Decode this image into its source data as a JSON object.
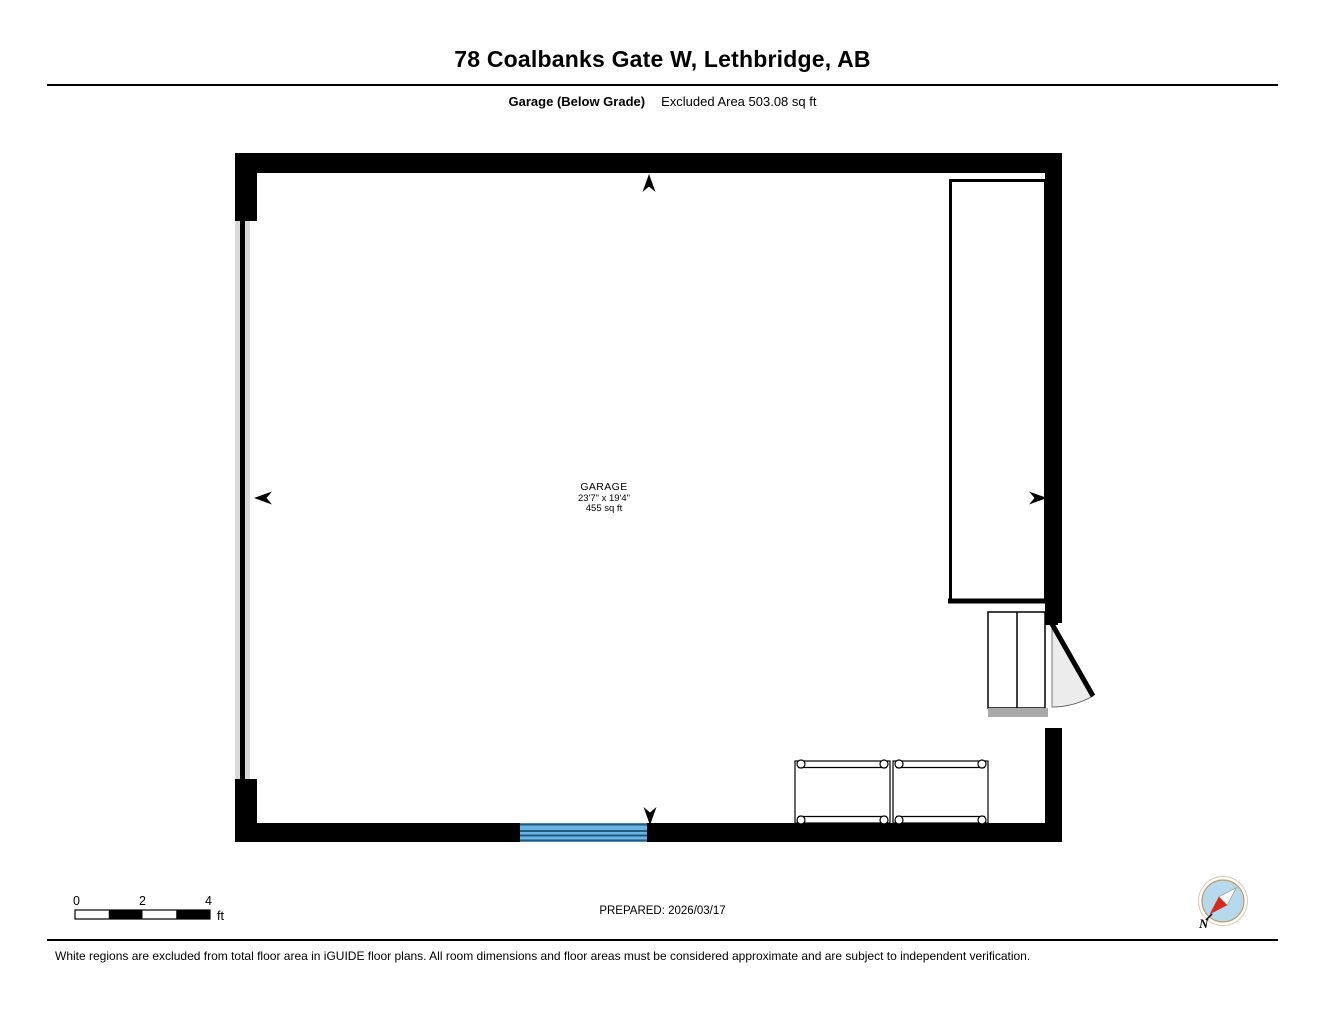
{
  "header": {
    "title": "78 Coalbanks Gate W, Lethbridge, AB",
    "floor_label": "Garage (Below Grade)",
    "excluded_area": "Excluded Area 503.08 sq ft"
  },
  "room": {
    "name": "GARAGE",
    "dimensions": "23'7\" x 19'4\"",
    "area": "455 sq ft"
  },
  "scale_bar": {
    "ticks": [
      "0",
      "2",
      "4"
    ],
    "unit": "ft"
  },
  "compass": {
    "north_label": "N"
  },
  "prepared": {
    "label": "PREPARED: 2026/03/17"
  },
  "disclaimer": "White regions are excluded from total floor area in iGUIDE floor plans. All room dimensions and floor areas must be considered approximate and are subject to independent verification.",
  "colors": {
    "wall": "#000000",
    "window_fill": "#6fb4e0",
    "window_line": "#1e5d87",
    "foundation_gray": "#d9d9d9",
    "landing_gray": "#a9a9a9",
    "door_swing_fill": "#ececec",
    "compass_fill": "#b7d9ee",
    "compass_ring": "#bd9a67",
    "needle_red": "#d7281d"
  }
}
